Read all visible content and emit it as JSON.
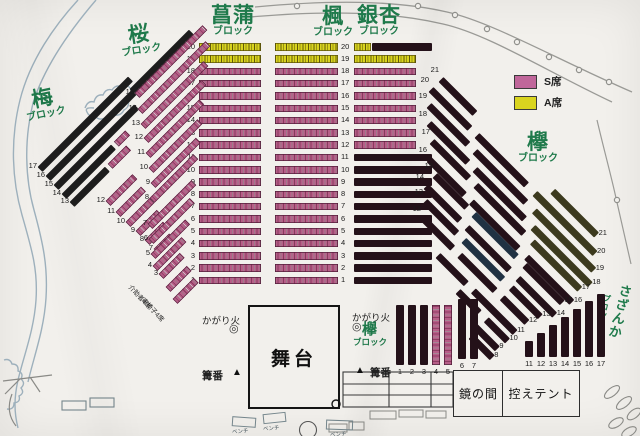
{
  "palette": {
    "paper": "#f2f0ec",
    "green": "#1f7a4b",
    "s_pink": "#b75e88",
    "a_yellow": "#d9d41f",
    "sold_black": "#1d1d1d",
    "sold_maroon": "#241119",
    "olive": "#3c3a1e",
    "navy": "#203243",
    "stream": "#9db0bc",
    "path_gray": "#9a9a96"
  },
  "legend": {
    "items": [
      {
        "name": "s-seat",
        "label": "S席",
        "color": "#c0669a"
      },
      {
        "name": "a-seat",
        "label": "A席",
        "color": "#d9d41f"
      }
    ]
  },
  "stage": {
    "label": "舞台"
  },
  "rooms": {
    "mirror": "鏡の間",
    "tent": "控えテント"
  },
  "marks": {
    "bonfire": "かがり火",
    "bonfire_icon": "◎",
    "keeper": "篝番",
    "keeper_icon": "▲",
    "bench": "ベンチ"
  },
  "blocks": {
    "ume": {
      "title": "梅",
      "sub": "ブロック"
    },
    "sakura": {
      "title": "桜",
      "sub": "ブロック"
    },
    "shobu": {
      "title": "菖蒲",
      "sub": "ブロック"
    },
    "kaede": {
      "title": "楓",
      "sub": "ブロック"
    },
    "icho": {
      "title": "銀杏",
      "sub": "ブロック"
    },
    "keyaki": {
      "title": "欅",
      "sub": "ブロック"
    },
    "sazanka": {
      "title": "さざんか",
      "sub": "ブロック"
    }
  },
  "center": {
    "rows": [
      {
        "n": "20",
        "shobu": "A",
        "kaede": "A",
        "icho": "A_SOLD"
      },
      {
        "n": "19",
        "shobu": "A",
        "kaede": "A",
        "icho": "A"
      },
      {
        "n": "18",
        "shobu": "S",
        "kaede": "S",
        "icho": "S"
      },
      {
        "n": "17",
        "shobu": "S",
        "kaede": "S",
        "icho": "S"
      },
      {
        "n": "16",
        "shobu": "S",
        "kaede": "S",
        "icho": "S"
      },
      {
        "n": "15",
        "shobu": "S",
        "kaede": "S",
        "icho": "S"
      },
      {
        "n": "14",
        "shobu": "S",
        "kaede": "S",
        "icho": "S"
      },
      {
        "n": "13",
        "shobu": "S",
        "kaede": "S",
        "icho": "S"
      },
      {
        "n": "12",
        "shobu": "S",
        "kaede": "S",
        "icho": "S"
      },
      {
        "n": "11",
        "shobu": "S",
        "kaede": "S",
        "icho": "SOLD"
      },
      {
        "n": "10",
        "shobu": "S",
        "kaede": "S",
        "icho": "SOLD"
      },
      {
        "n": "9",
        "shobu": "S",
        "kaede": "S",
        "icho": "SOLD"
      },
      {
        "n": "8",
        "shobu": "S",
        "kaede": "S",
        "icho": "SOLD"
      },
      {
        "n": "7",
        "shobu": "S",
        "kaede": "S",
        "icho": "SOLD"
      },
      {
        "n": "6",
        "shobu": "S",
        "kaede": "S",
        "icho": "SOLD"
      },
      {
        "n": "5",
        "shobu": "S",
        "kaede": "S",
        "icho": "SOLD"
      },
      {
        "n": "4",
        "shobu": "S",
        "kaede": "S",
        "icho": "SOLD"
      },
      {
        "n": "3",
        "shobu": "S",
        "kaede": "S",
        "icho": "SOLD"
      },
      {
        "n": "2",
        "shobu": "S",
        "kaede": "S",
        "icho": "SOLD"
      },
      {
        "n": "1",
        "shobu": "S",
        "kaede": "S",
        "icho": "SOLD"
      }
    ]
  },
  "fans": {
    "ume_rows": [
      {
        "n": "17",
        "x": 40,
        "y": 166,
        "segs": [
          [
            "black",
            128
          ]
        ]
      },
      {
        "n": "16",
        "x": 48,
        "y": 175,
        "segs": [
          [
            "black",
            122
          ]
        ]
      },
      {
        "n": "15",
        "x": 56,
        "y": 184,
        "segs": [
          [
            "black",
            114
          ]
        ]
      },
      {
        "n": "14",
        "x": 64,
        "y": 193,
        "segs": [
          [
            "black",
            70
          ],
          [
            "gap",
            4
          ],
          [
            "s",
            16
          ]
        ]
      },
      {
        "n": "13",
        "x": 72,
        "y": 201,
        "segs": [
          [
            "black",
            50
          ],
          [
            "gap",
            4
          ],
          [
            "s",
            26
          ]
        ]
      },
      {
        "n": "12",
        "x": 108,
        "y": 200,
        "segs": [
          [
            "s",
            38
          ]
        ]
      },
      {
        "n": "11",
        "x": 118,
        "y": 211,
        "segs": [
          [
            "s",
            36
          ]
        ]
      },
      {
        "n": "10",
        "x": 128,
        "y": 221,
        "segs": [
          [
            "s",
            34
          ]
        ]
      },
      {
        "n": "9",
        "x": 138,
        "y": 230,
        "segs": [
          [
            "s",
            30
          ]
        ]
      },
      {
        "n": "8",
        "x": 147,
        "y": 239,
        "segs": [
          [
            "s",
            26
          ]
        ]
      },
      {
        "n": "7",
        "x": 156,
        "y": 248,
        "segs": [
          [
            "s",
            22
          ]
        ]
      }
    ],
    "sakura_rows": [
      {
        "n": "",
        "x": 132,
        "y": 88,
        "segs": [
          [
            "black",
            84
          ]
        ]
      },
      {
        "n": "15",
        "x": 137,
        "y": 92,
        "segs": [
          [
            "s",
            96
          ]
        ]
      },
      {
        "n": "14",
        "x": 140,
        "y": 108,
        "segs": [
          [
            "s",
            96
          ]
        ]
      },
      {
        "n": "13",
        "x": 143,
        "y": 123,
        "segs": [
          [
            "s",
            89
          ]
        ]
      },
      {
        "n": "12",
        "x": 146,
        "y": 137,
        "segs": [
          [
            "s",
            82
          ]
        ]
      },
      {
        "n": "11",
        "x": 148,
        "y": 152,
        "segs": [
          [
            "s",
            76
          ]
        ]
      },
      {
        "n": "10",
        "x": 151,
        "y": 167,
        "segs": [
          [
            "s",
            69
          ]
        ]
      },
      {
        "n": "9",
        "x": 153,
        "y": 182,
        "segs": [
          [
            "s",
            64
          ]
        ]
      },
      {
        "n": "8",
        "x": 152,
        "y": 197,
        "segs": [
          [
            "s",
            62
          ]
        ]
      },
      {
        "n": "7",
        "x": 150,
        "y": 223,
        "segs": [
          [
            "s",
            62
          ]
        ]
      },
      {
        "n": "6",
        "x": 151,
        "y": 238,
        "segs": [
          [
            "s",
            58
          ]
        ]
      },
      {
        "n": "5",
        "x": 153,
        "y": 253,
        "segs": [
          [
            "s",
            49
          ]
        ]
      },
      {
        "n": "4",
        "x": 155,
        "y": 265,
        "segs": [
          [
            "s",
            41
          ]
        ]
      },
      {
        "n": "3",
        "x": 161,
        "y": 273,
        "segs": [
          [
            "s",
            30
          ]
        ]
      }
    ],
    "sakura_special": [
      {
        "label": "介助者4席",
        "lx": 134,
        "ly": 282,
        "x": 168,
        "y": 286,
        "segs": [
          [
            "s",
            30
          ]
        ]
      },
      {
        "label": "車椅子4席",
        "lx": 147,
        "ly": 295,
        "x": 175,
        "y": 298,
        "segs": [
          [
            "s",
            30
          ]
        ]
      }
    ],
    "keyaki_rows": [
      {
        "n": "21",
        "x": 441,
        "y": 76,
        "ns": 1,
        "segs": [
          [
            "sold",
            48
          ],
          [
            "gap",
            110
          ],
          [
            "olive",
            62
          ]
        ]
      },
      {
        "n": "20",
        "x": 431,
        "y": 86,
        "ns": 1,
        "segs": [
          [
            "sold",
            55
          ],
          [
            "gap",
            10
          ],
          [
            "sold",
            70
          ],
          [
            "gap",
            12
          ],
          [
            "olive",
            85
          ]
        ]
      },
      {
        "n": "19",
        "x": 429,
        "y": 102,
        "ns": 1,
        "segs": [
          [
            "sold",
            55
          ],
          [
            "gap",
            10
          ],
          [
            "sold",
            72
          ],
          [
            "gap",
            12
          ],
          [
            "olive",
            84
          ]
        ]
      },
      {
        "n": "18",
        "x": 429,
        "y": 120,
        "ns": 1,
        "segs": [
          [
            "sold",
            55
          ],
          [
            "gap",
            10
          ],
          [
            "sold",
            70
          ],
          [
            "gap",
            12
          ],
          [
            "olive",
            81
          ]
        ]
      },
      {
        "n": "17",
        "x": 432,
        "y": 138,
        "ns": 1,
        "segs": [
          [
            "sold",
            52
          ],
          [
            "gap",
            10
          ],
          [
            "sold",
            68
          ],
          [
            "gap",
            12
          ],
          [
            "olive",
            67
          ]
        ]
      },
      {
        "n": "16",
        "x": 429,
        "y": 156,
        "ns": 1,
        "segs": [
          [
            "sold",
            50
          ],
          [
            "gap",
            10
          ],
          [
            "sold",
            66
          ],
          [
            "gap",
            12
          ],
          [
            "sold",
            64
          ]
        ]
      },
      {
        "n": "15",
        "x": 435,
        "y": 172,
        "ns": 1,
        "segs": [
          [
            "sold",
            45
          ],
          [
            "gap",
            10
          ],
          [
            "navy",
            60
          ],
          [
            "gap",
            12
          ],
          [
            "sold",
            53
          ]
        ]
      },
      {
        "n": "14",
        "x": 426,
        "y": 183,
        "ns": 1,
        "segs": [
          [
            "sold",
            48
          ],
          [
            "gap",
            10
          ],
          [
            "sold",
            60
          ],
          [
            "gap",
            12
          ],
          [
            "sold",
            52
          ]
        ]
      },
      {
        "n": "13",
        "x": 425,
        "y": 198,
        "ns": 1,
        "segs": [
          [
            "sold",
            45
          ],
          [
            "gap",
            10
          ],
          [
            "navy",
            55
          ],
          [
            "gap",
            12
          ],
          [
            "sold",
            41
          ]
        ]
      },
      {
        "n": "12",
        "x": 423,
        "y": 215,
        "ns": 1,
        "segs": [
          [
            "sold",
            42
          ],
          [
            "gap",
            10
          ],
          [
            "sold",
            50
          ],
          [
            "gap",
            10
          ],
          [
            "sold",
            35
          ]
        ]
      },
      {
        "n": "11",
        "x": 438,
        "y": 252,
        "ns": 0,
        "segs": [
          [
            "sold",
            40
          ],
          [
            "gap",
            10
          ],
          [
            "sold",
            59
          ]
        ]
      },
      {
        "n": "10",
        "x": 458,
        "y": 288,
        "ns": 0,
        "segs": [
          [
            "sold",
            30
          ],
          [
            "gap",
            10
          ],
          [
            "sold",
            30
          ]
        ]
      },
      {
        "n": "9",
        "x": 474,
        "y": 322,
        "ns": 0,
        "segs": [
          [
            "sold",
            33
          ]
        ]
      },
      {
        "n": "8",
        "x": 471,
        "y": 333,
        "ns": 0,
        "segs": [
          [
            "sold",
            30
          ]
        ]
      }
    ]
  },
  "columns": {
    "keyaki": [
      {
        "n": "1",
        "x": 396,
        "y": 305,
        "h": 60,
        "t": "sold"
      },
      {
        "n": "2",
        "x": 408,
        "y": 305,
        "h": 60,
        "t": "sold"
      },
      {
        "n": "3",
        "x": 420,
        "y": 305,
        "h": 60,
        "t": "sold"
      },
      {
        "n": "4",
        "x": 432,
        "y": 305,
        "h": 60,
        "t": "s"
      },
      {
        "n": "5",
        "x": 444,
        "y": 305,
        "h": 60,
        "t": "s"
      },
      {
        "n": "6",
        "x": 458,
        "y": 299,
        "h": 60,
        "t": "sold"
      },
      {
        "n": "7",
        "x": 470,
        "y": 299,
        "h": 60,
        "t": "sold"
      }
    ],
    "sazanka": [
      {
        "n": "11",
        "x": 525,
        "h": 16,
        "t": "sold"
      },
      {
        "n": "12",
        "x": 537,
        "h": 24,
        "t": "sold"
      },
      {
        "n": "13",
        "x": 549,
        "h": 32,
        "t": "sold"
      },
      {
        "n": "14",
        "x": 561,
        "h": 40,
        "t": "sold"
      },
      {
        "n": "15",
        "x": 573,
        "h": 48,
        "t": "sold"
      },
      {
        "n": "16",
        "x": 585,
        "h": 56,
        "t": "sold"
      },
      {
        "n": "17",
        "x": 597,
        "h": 63,
        "t": "sold"
      }
    ]
  }
}
